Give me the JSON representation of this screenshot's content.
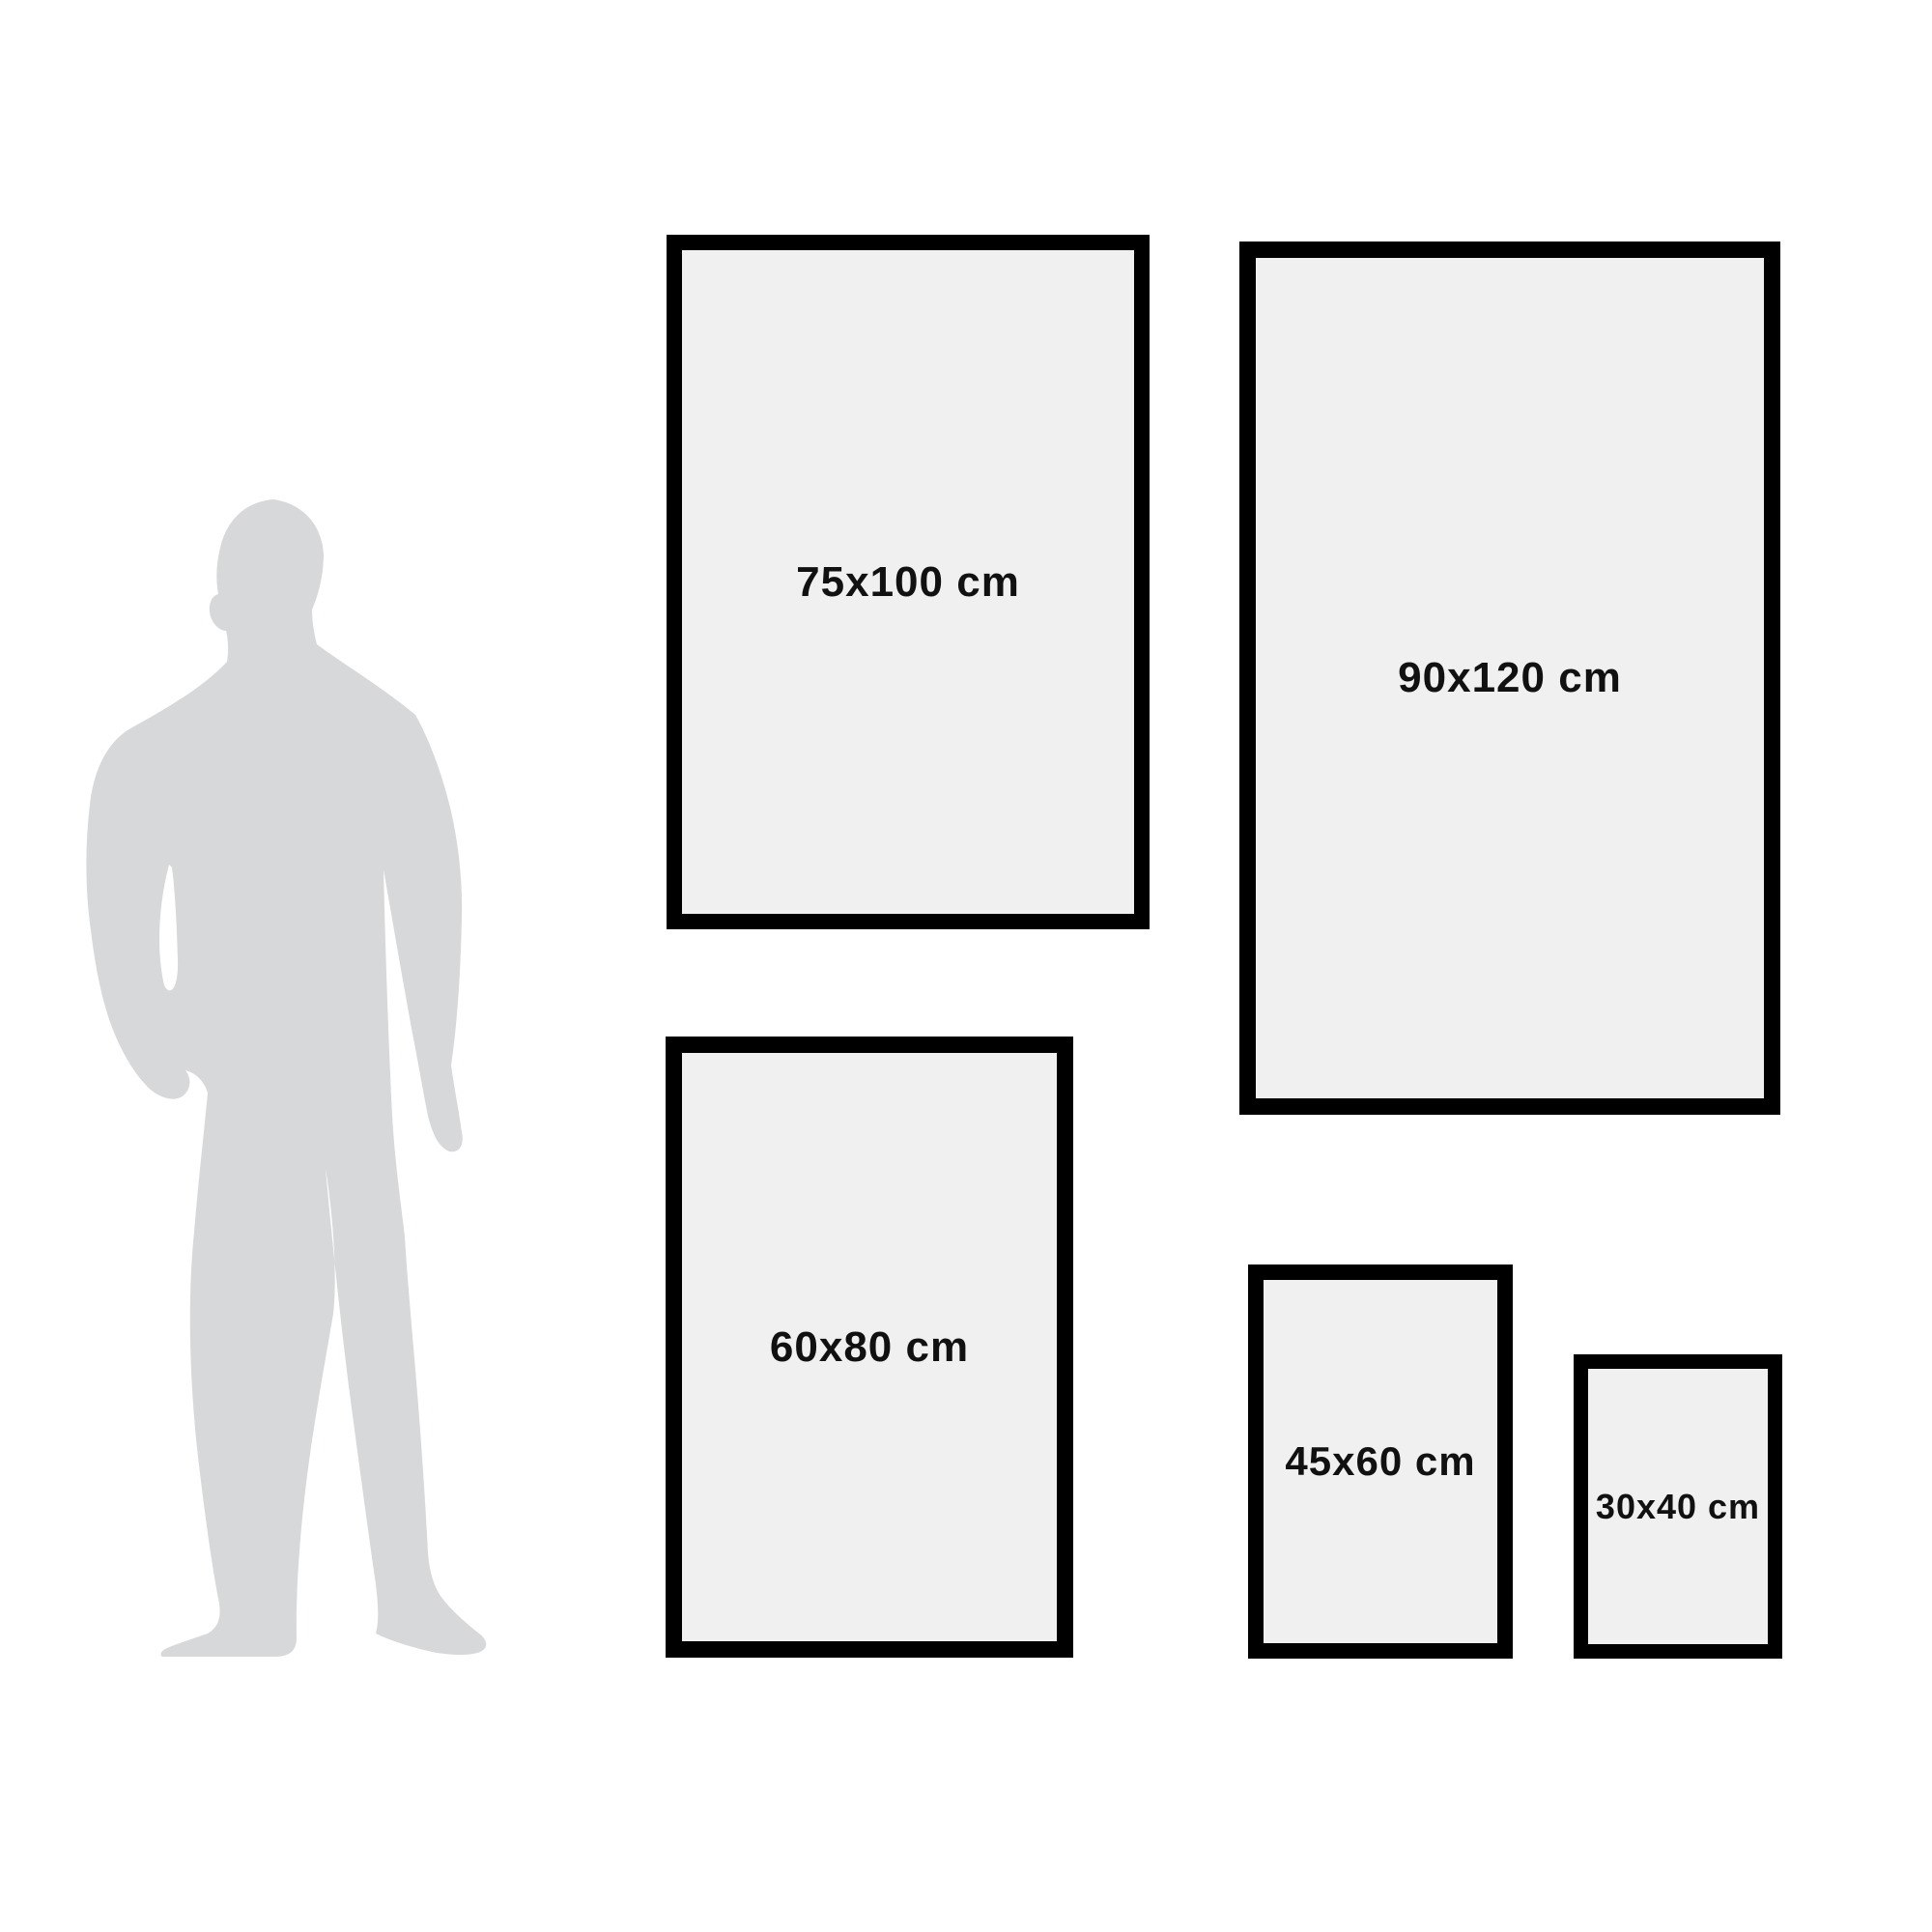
{
  "size_guide": {
    "frames": [
      {
        "label": "75x100 cm"
      },
      {
        "label": "90x120 cm"
      },
      {
        "label": "60x80 cm"
      },
      {
        "label": "45x60 cm"
      },
      {
        "label": "30x40 cm"
      }
    ],
    "colors": {
      "background": "#ffffff",
      "frame_border": "#000000",
      "frame_fill": "#f0f0f0",
      "silhouette": "#d7d8d9",
      "label_text": "#111111"
    }
  }
}
